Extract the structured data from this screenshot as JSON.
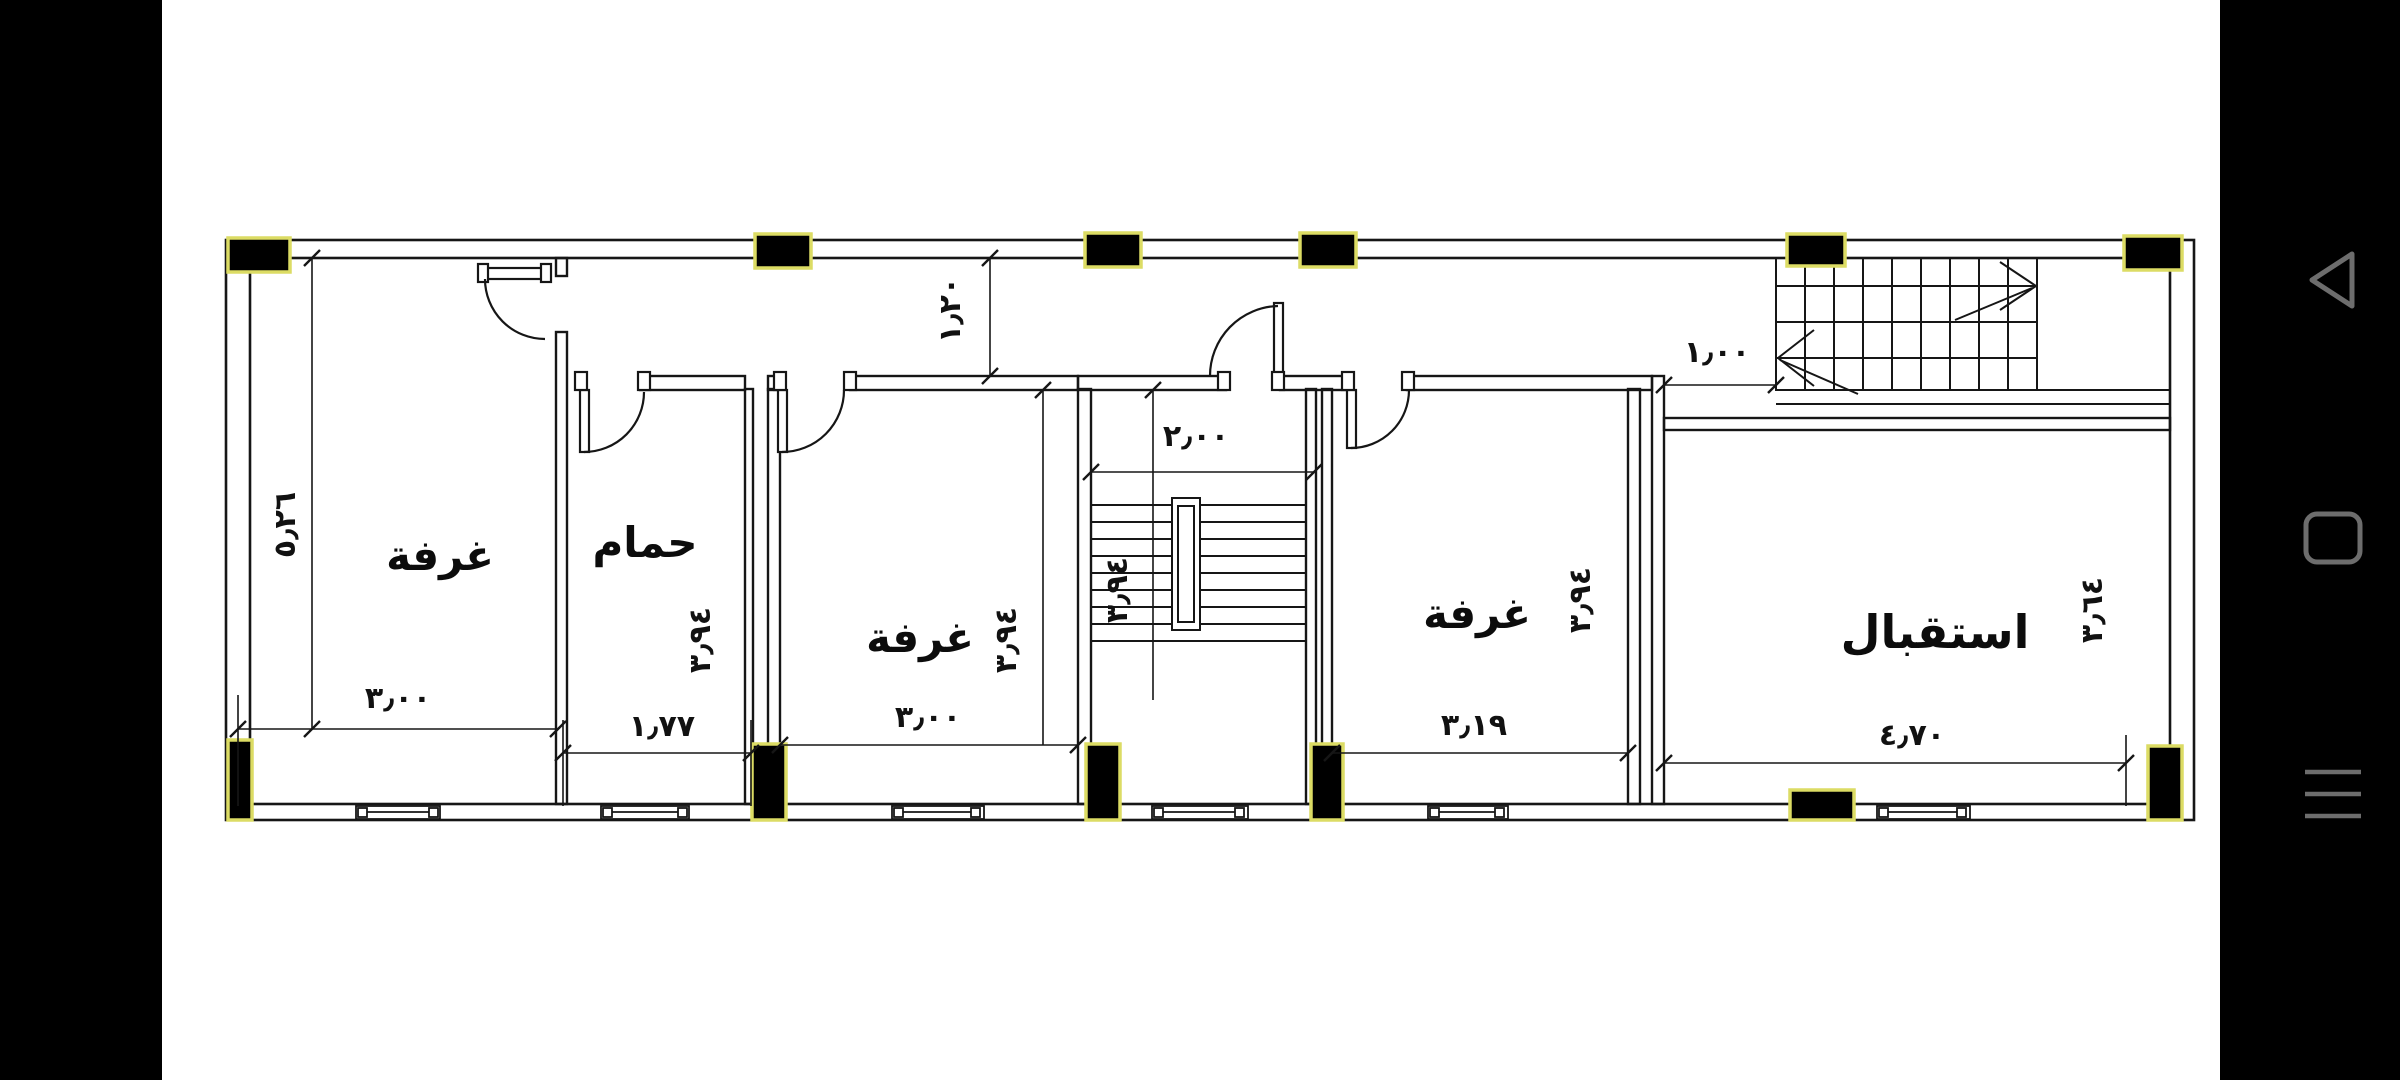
{
  "app": {
    "type": "cad-floor-plan-viewer",
    "canvas_bg": "#ffffff",
    "screen_bg": "#000000"
  },
  "colors": {
    "line": "#161616",
    "column_fill": "#000000",
    "column_stroke": "#dcdc64",
    "nav_icon": "#6d6d6d"
  },
  "floor_plan": {
    "rooms": [
      {
        "id": "room-left",
        "label": "غرفة"
      },
      {
        "id": "bathroom",
        "label": "حمام"
      },
      {
        "id": "room-middle",
        "label": "غرفة"
      },
      {
        "id": "room-right",
        "label": "غرفة"
      },
      {
        "id": "reception",
        "label": "استقبال"
      }
    ],
    "dimensions": {
      "overall_left": "٥٫٢٦",
      "corridor_depth": "١٫٢٠",
      "stair_width": "٢٫٠٠",
      "stair_passage": "١٫٠٠",
      "room_left_width": "٣٫٠٠",
      "bathroom_width": "١٫٧٧",
      "room_middle_width": "٣٫٠٠",
      "room_right_width": "٣٫١٩",
      "reception_width": "٤٫٧٠",
      "bathroom_depth": "٣٫٩٤",
      "room_middle_depth": "٣٫٩٤",
      "stair_depth": "٣٫٩٤",
      "room_right_depth": "٣٫٩٤",
      "reception_depth": "٣٫٦٤"
    }
  },
  "nav_bar": {
    "buttons": [
      {
        "id": "back",
        "icon": "back-triangle-icon"
      },
      {
        "id": "home",
        "icon": "home-square-icon"
      },
      {
        "id": "recents",
        "icon": "recents-lines-icon"
      }
    ]
  }
}
